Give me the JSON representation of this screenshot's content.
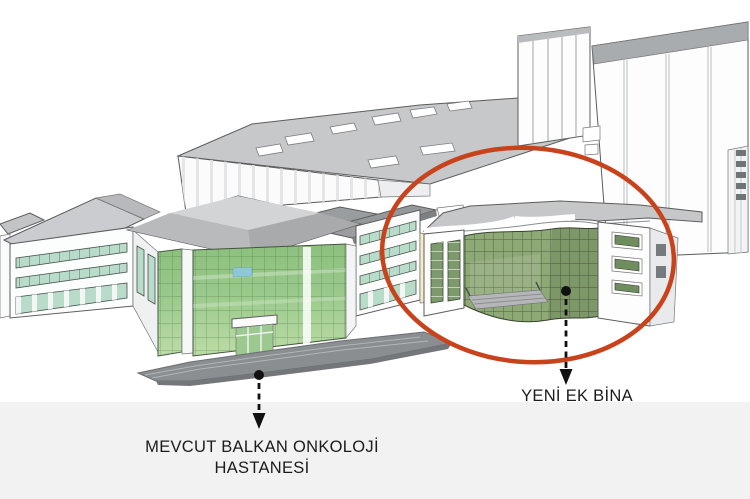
{
  "annotations": {
    "existing_hospital": {
      "line1": "MEVCUT BALKAN ONKOLOJİ",
      "line2": "HASTANESİ"
    },
    "new_annex": {
      "label": "YENİ EK BİNA"
    }
  },
  "scene": {
    "buildings": [
      {
        "name": "existing-balkan-oncology-hospital"
      },
      {
        "name": "new-annex-building",
        "highlighted": true
      },
      {
        "name": "background-block"
      },
      {
        "name": "tall-tower"
      }
    ]
  },
  "colors": {
    "accent": "#c8431c",
    "band": "#f2f2f2",
    "glass-bright-top": "#8cbf7e",
    "glass-bright-mid": "#9aca8b",
    "glass-bright-bottom": "#bcdca6",
    "glass-sage": "#8ea976",
    "window-teal": "#b9dbc9",
    "cream-wall": "#f5ecca",
    "text": "#1b1b1b",
    "arrow": "#111111"
  }
}
